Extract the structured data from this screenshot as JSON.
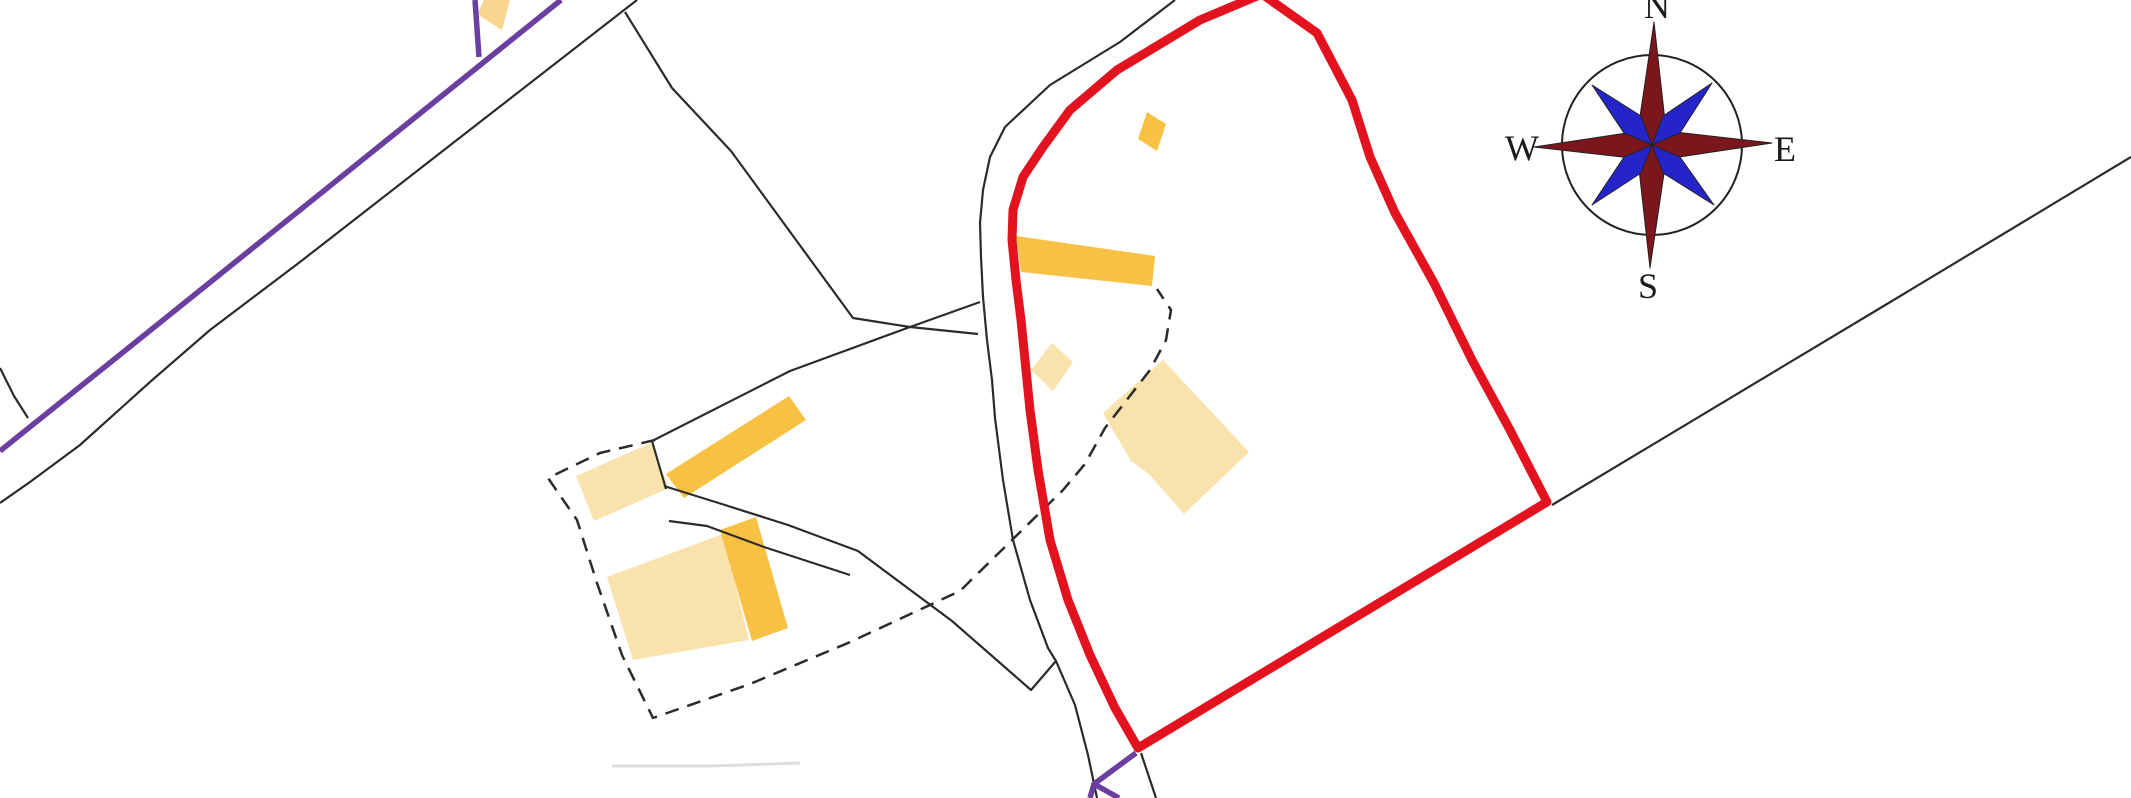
{
  "map": {
    "title": "site-location-plan",
    "background": "#ffffff",
    "palette": {
      "site_boundary_red": "#e2131f",
      "road_purple": "#6a3fa0",
      "parcel_line_black": "#2b2b2b",
      "building_orange": "#f7c143",
      "building_pale_orange": "#fae2ac",
      "building_light_amber": "#f8d68f",
      "compass_needle_red": "#7a161c",
      "compass_needle_blue": "#2424c8",
      "faint_line_gray": "#dedede"
    },
    "compass": {
      "north_label": "N",
      "east_label": "E",
      "south_label": "S",
      "west_label": "W"
    },
    "shapes": [
      {
        "name": "faint-erased-line",
        "type": "polyline",
        "points": [
          [
            612,
            766
          ],
          [
            710,
            766
          ],
          [
            800,
            763
          ]
        ],
        "stroke": "#dedede",
        "width": 3
      },
      {
        "name": "pale-building-farm-northwest",
        "type": "polygon",
        "points": [
          [
            651,
            443
          ],
          [
            576,
            476
          ],
          [
            594,
            521
          ],
          [
            669,
            488
          ]
        ],
        "fill": "#fae2ac"
      },
      {
        "name": "pale-building-farm-south",
        "type": "polygon",
        "points": [
          [
            607,
            577
          ],
          [
            723,
            534
          ],
          [
            749,
            640
          ],
          [
            633,
            660
          ]
        ],
        "fill": "#fae2ac"
      },
      {
        "name": "pale-building-small-diamond",
        "type": "polygon",
        "points": [
          [
            1052,
            343
          ],
          [
            1073,
            362
          ],
          [
            1053,
            391
          ],
          [
            1031,
            370
          ]
        ],
        "fill": "#fae2ac"
      },
      {
        "name": "pale-building-main-in-site",
        "type": "polygon",
        "points": [
          [
            1163,
            360
          ],
          [
            1249,
            452
          ],
          [
            1184,
            514
          ],
          [
            1149,
            474
          ],
          [
            1131,
            461
          ],
          [
            1103,
            413
          ]
        ],
        "fill": "#fae2ac"
      },
      {
        "name": "orange-building-top-left-road",
        "type": "polygon",
        "points": [
          [
            486,
            -4
          ],
          [
            511,
            -4
          ],
          [
            502,
            30
          ],
          [
            477,
            14
          ]
        ],
        "fill": "#f8d68f"
      },
      {
        "name": "orange-building-long-north",
        "type": "polygon",
        "points": [
          [
            1016,
            236
          ],
          [
            1155,
            256
          ],
          [
            1152,
            286
          ],
          [
            1021,
            272
          ]
        ],
        "fill": "#f7c143"
      },
      {
        "name": "orange-building-small-top",
        "type": "polygon",
        "points": [
          [
            1147,
            112
          ],
          [
            1166,
            124
          ],
          [
            1157,
            151
          ],
          [
            1138,
            139
          ]
        ],
        "fill": "#f7c143"
      },
      {
        "name": "orange-building-farm-diagonal",
        "type": "polygon",
        "points": [
          [
            666,
            474
          ],
          [
            789,
            396
          ],
          [
            806,
            420
          ],
          [
            684,
            498
          ]
        ],
        "fill": "#f7c143"
      },
      {
        "name": "orange-building-farm-wing",
        "type": "polygon",
        "points": [
          [
            720,
            530
          ],
          [
            756,
            517
          ],
          [
            788,
            628
          ],
          [
            752,
            641
          ]
        ],
        "fill": "#f7c143"
      },
      {
        "name": "parcel-line-road-left-edge",
        "type": "polyline",
        "points": [
          [
            637,
            0
          ],
          [
            480,
            122
          ],
          [
            300,
            262
          ],
          [
            210,
            330
          ],
          [
            150,
            382
          ],
          [
            80,
            445
          ],
          [
            30,
            482
          ],
          [
            0,
            503
          ]
        ],
        "stroke": "#2b2b2b",
        "width": 2.2
      },
      {
        "name": "parcel-line-left-branch-curve",
        "type": "polyline",
        "points": [
          [
            0,
            368
          ],
          [
            14,
            396
          ],
          [
            28,
            418
          ]
        ],
        "stroke": "#2b2b2b",
        "width": 2.2
      },
      {
        "name": "parcel-line-top-field",
        "type": "polyline",
        "points": [
          [
            625,
            12
          ],
          [
            672,
            88
          ],
          [
            731,
            151
          ],
          [
            853,
            318
          ],
          [
            910,
            327
          ],
          [
            978,
            334
          ]
        ],
        "stroke": "#2b2b2b",
        "width": 2.2
      },
      {
        "name": "parcel-line-cross-field",
        "type": "polyline",
        "points": [
          [
            652,
            441
          ],
          [
            790,
            371
          ],
          [
            910,
            327
          ],
          [
            980,
            302
          ]
        ],
        "stroke": "#2b2b2b",
        "width": 2.2
      },
      {
        "name": "parcel-line-farm-vertical",
        "type": "polyline",
        "points": [
          [
            652,
            441
          ],
          [
            666,
            489
          ]
        ],
        "stroke": "#2b2b2b",
        "width": 2.2
      },
      {
        "name": "parcel-line-road-edge-west-of-site",
        "type": "polyline",
        "points": [
          [
            1175,
            0
          ],
          [
            1120,
            42
          ],
          [
            1050,
            85
          ],
          [
            1005,
            127
          ],
          [
            990,
            157
          ],
          [
            983,
            190
          ],
          [
            980,
            223
          ],
          [
            981,
            257
          ],
          [
            983,
            297
          ],
          [
            987,
            340
          ],
          [
            992,
            380
          ],
          [
            995,
            418
          ],
          [
            1003,
            480
          ],
          [
            1013,
            540
          ],
          [
            1030,
            600
          ],
          [
            1048,
            648
          ],
          [
            1056,
            661
          ],
          [
            1075,
            705
          ],
          [
            1088,
            755
          ],
          [
            1097,
            798
          ]
        ],
        "stroke": "#2b2b2b",
        "width": 2.2
      },
      {
        "name": "track-upper-edge",
        "type": "polyline",
        "points": [
          [
            664,
            486
          ],
          [
            725,
            505
          ],
          [
            788,
            525
          ],
          [
            858,
            551
          ],
          [
            952,
            621
          ],
          [
            1031,
            690
          ],
          [
            1056,
            661
          ]
        ],
        "stroke": "#2b2b2b",
        "width": 2.2
      },
      {
        "name": "track-lower-edge",
        "type": "polyline",
        "points": [
          [
            669,
            521
          ],
          [
            707,
            526
          ],
          [
            764,
            547
          ],
          [
            810,
            562
          ],
          [
            850,
            575
          ]
        ],
        "stroke": "#2b2b2b",
        "width": 2.2
      },
      {
        "name": "parcel-line-long-east-boundary",
        "type": "polyline",
        "points": [
          [
            2131,
            157
          ],
          [
            1877,
            310
          ],
          [
            1552,
            505
          ]
        ],
        "stroke": "#2b2b2b",
        "width": 2.2
      },
      {
        "name": "parcel-line-stub-below-red-corner",
        "type": "polyline",
        "points": [
          [
            1141,
            753
          ],
          [
            1156,
            798
          ]
        ],
        "stroke": "#2b2b2b",
        "width": 2.2
      },
      {
        "name": "dashed-boundary-farmstead",
        "type": "polyline",
        "points": [
          [
            655,
            440
          ],
          [
            600,
            453
          ],
          [
            548,
            478
          ],
          [
            577,
            520
          ],
          [
            597,
            583
          ],
          [
            622,
            655
          ],
          [
            653,
            718
          ],
          [
            750,
            684
          ],
          [
            848,
            643
          ],
          [
            960,
            591
          ],
          [
            1063,
            490
          ],
          [
            1085,
            464
          ],
          [
            1105,
            428
          ],
          [
            1150,
            370
          ],
          [
            1166,
            340
          ],
          [
            1171,
            310
          ],
          [
            1157,
            289
          ]
        ],
        "stroke": "#2b2b2b",
        "width": 2.5,
        "dash": "14 9"
      },
      {
        "name": "road-purple-main",
        "type": "polyline",
        "points": [
          [
            561,
            0
          ],
          [
            300,
            210
          ],
          [
            147,
            333
          ],
          [
            0,
            451
          ]
        ],
        "stroke": "#6a3fa0",
        "width": 5.5
      },
      {
        "name": "road-purple-stub",
        "type": "polyline",
        "points": [
          [
            475,
            0
          ],
          [
            479,
            57
          ]
        ],
        "stroke": "#6a3fa0",
        "width": 5.5
      },
      {
        "name": "road-purple-bottom-fragment",
        "type": "polyline",
        "points": [
          [
            1136,
            753
          ],
          [
            1094,
            784
          ],
          [
            1119,
            798
          ]
        ],
        "stroke": "#6a3fa0",
        "width": 5.5
      },
      {
        "name": "road-purple-bottom-spur",
        "type": "polyline",
        "points": [
          [
            1094,
            784
          ],
          [
            1090,
            798
          ]
        ],
        "stroke": "#6a3fa0",
        "width": 5.5
      },
      {
        "name": "site-boundary-red",
        "type": "polygon",
        "points": [
          [
            1262,
            -6
          ],
          [
            1317,
            33
          ],
          [
            1352,
            100
          ],
          [
            1370,
            157
          ],
          [
            1395,
            213
          ],
          [
            1434,
            283
          ],
          [
            1472,
            360
          ],
          [
            1510,
            430
          ],
          [
            1547,
            502
          ],
          [
            1138,
            748
          ],
          [
            1115,
            708
          ],
          [
            1090,
            655
          ],
          [
            1068,
            600
          ],
          [
            1050,
            540
          ],
          [
            1038,
            470
          ],
          [
            1030,
            410
          ],
          [
            1025,
            360
          ],
          [
            1021,
            320
          ],
          [
            1016,
            280
          ],
          [
            1012,
            240
          ],
          [
            1013,
            210
          ],
          [
            1023,
            177
          ],
          [
            1043,
            147
          ],
          [
            1070,
            110
          ],
          [
            1117,
            70
          ],
          [
            1200,
            20
          ]
        ],
        "fill": "none",
        "stroke": "#e2131f",
        "width": 9
      },
      {
        "name": "compass-circle",
        "type": "circle",
        "cx": 1652,
        "cy": 145,
        "r": 90,
        "fill": "none",
        "stroke": "#222222",
        "width": 2
      },
      {
        "name": "compass-needle-north",
        "type": "polygon",
        "points": [
          [
            1654,
            22
          ],
          [
            1666,
            130
          ],
          [
            1652,
            145
          ],
          [
            1638,
            130
          ]
        ],
        "fill": "#7a161c",
        "stroke": "#222222",
        "width": 1
      },
      {
        "name": "compass-needle-south",
        "type": "polygon",
        "points": [
          [
            1650,
            268
          ],
          [
            1666,
            160
          ],
          [
            1652,
            145
          ],
          [
            1638,
            160
          ]
        ],
        "fill": "#7a161c",
        "stroke": "#222222",
        "width": 1
      },
      {
        "name": "compass-needle-west",
        "type": "polygon",
        "points": [
          [
            1534,
            147
          ],
          [
            1640,
            131
          ],
          [
            1652,
            145
          ],
          [
            1640,
            159
          ]
        ],
        "fill": "#7a161c",
        "stroke": "#222222",
        "width": 1
      },
      {
        "name": "compass-needle-east",
        "type": "polygon",
        "points": [
          [
            1772,
            143
          ],
          [
            1666,
            131
          ],
          [
            1652,
            145
          ],
          [
            1666,
            159
          ]
        ],
        "fill": "#7a161c",
        "stroke": "#222222",
        "width": 1
      },
      {
        "name": "compass-needle-northeast",
        "type": "polygon",
        "points": [
          [
            1712,
            83
          ],
          [
            1680,
            133
          ],
          [
            1652,
            145
          ],
          [
            1663,
            116
          ]
        ],
        "fill": "#2424c8",
        "stroke": "#222222",
        "width": 1
      },
      {
        "name": "compass-needle-northwest",
        "type": "polygon",
        "points": [
          [
            1592,
            85
          ],
          [
            1624,
            133
          ],
          [
            1652,
            145
          ],
          [
            1641,
            116
          ]
        ],
        "fill": "#2424c8",
        "stroke": "#222222",
        "width": 1
      },
      {
        "name": "compass-needle-southeast",
        "type": "polygon",
        "points": [
          [
            1714,
            205
          ],
          [
            1680,
            157
          ],
          [
            1652,
            145
          ],
          [
            1663,
            173
          ]
        ],
        "fill": "#2424c8",
        "stroke": "#222222",
        "width": 1
      },
      {
        "name": "compass-needle-southwest",
        "type": "polygon",
        "points": [
          [
            1592,
            205
          ],
          [
            1624,
            157
          ],
          [
            1652,
            145
          ],
          [
            1641,
            173
          ]
        ],
        "fill": "#2424c8",
        "stroke": "#222222",
        "width": 1
      },
      {
        "name": "compass-label-north",
        "type": "text",
        "x": 1644,
        "y": 18,
        "size": 36,
        "text": "N"
      },
      {
        "name": "compass-label-west",
        "type": "text",
        "x": 1505,
        "y": 160,
        "size": 36,
        "text": "W"
      },
      {
        "name": "compass-label-east",
        "type": "text",
        "x": 1774,
        "y": 161,
        "size": 36,
        "text": "E"
      },
      {
        "name": "compass-label-south",
        "type": "text",
        "x": 1638,
        "y": 298,
        "size": 36,
        "text": "S"
      }
    ]
  }
}
